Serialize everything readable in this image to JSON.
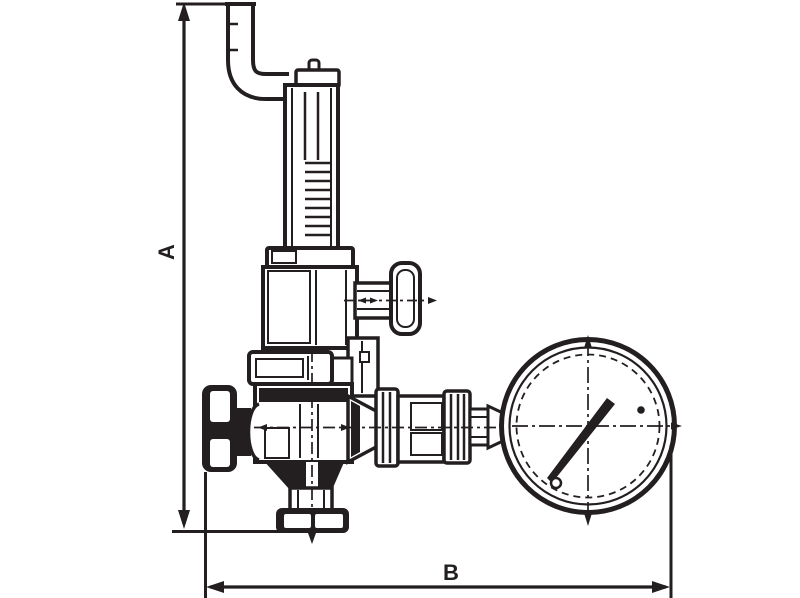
{
  "page": {
    "background_color": "#ffffff",
    "ink_color": "#231f20",
    "kind": "technical line drawing of a pressure reducing valve with vent pipe elbow and pressure gauge"
  },
  "drawing": {
    "dimension_a_label": "A",
    "dimension_b_label": "B"
  },
  "parts": [
    "vertical-dimension-a",
    "horizontal-dimension-b",
    "vent-pipe-elbow",
    "adjusting-cap",
    "spring-housing",
    "bonnet-flange",
    "bonnet",
    "side-tee-handle",
    "body-top-flange",
    "valve-body",
    "inlet-union-cap",
    "bottom-outlet-flange",
    "gauge-connection-fittings",
    "pressure-gauge",
    "gauge-needle"
  ]
}
